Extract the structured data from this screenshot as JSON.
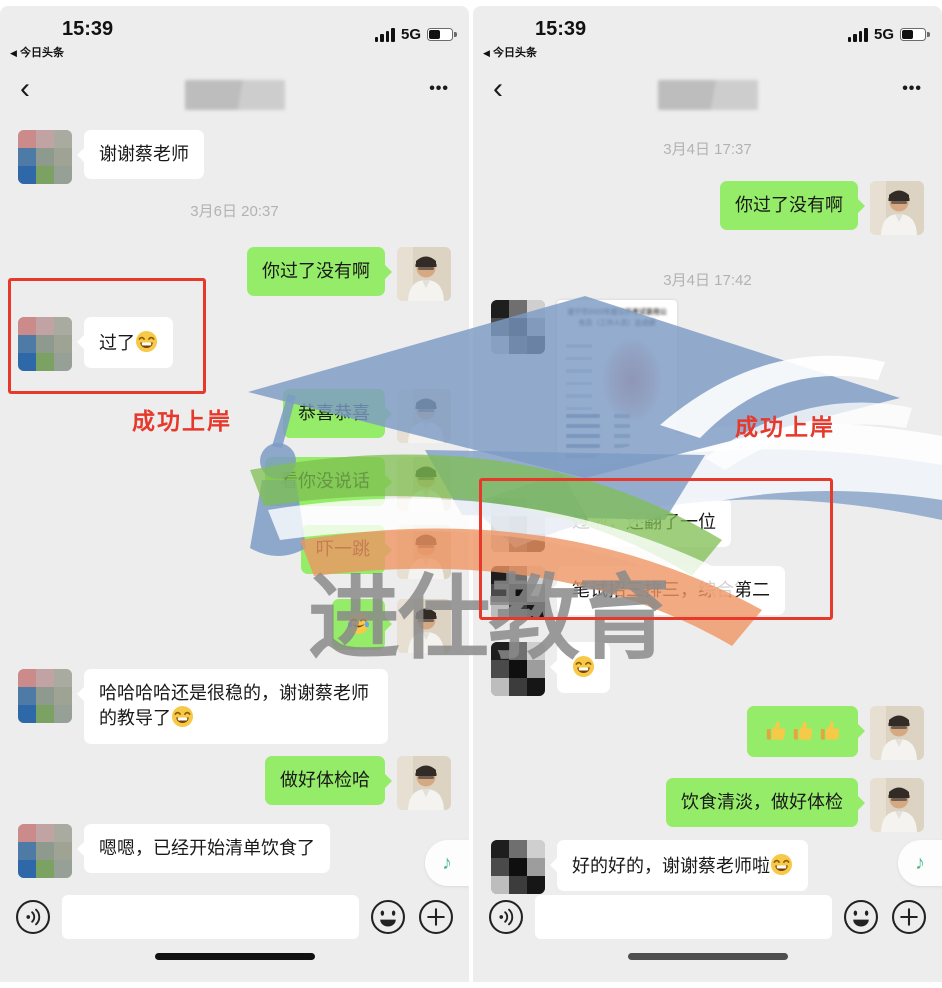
{
  "status_bar": {
    "time": "15:39",
    "back_app": "今日头条",
    "network": "5G"
  },
  "nav": {
    "back_glyph": "‹",
    "more_glyph": "•••"
  },
  "icons": {
    "back_to_app": "◀",
    "music_note": "♪",
    "voice": "voice-wave-in-circle",
    "emoji_picker": "smiley-face",
    "plus": "plus-in-circle"
  },
  "annotations": {
    "left_label": "成功上岸",
    "right_label": "成功上岸"
  },
  "watermark": {
    "brand": "进仕教育"
  },
  "colors": {
    "bubble_green": "#95ec69",
    "annotation_red": "#e6392c",
    "watermark_blue": "#7d9bc4"
  },
  "left_chat": {
    "t1": "3月6日 20:37",
    "m_thanks": "谢谢蔡老师",
    "m_pass_q": "你过了没有啊",
    "m_passed": "过了",
    "m_passed_emoji": "😁",
    "m_congrats": "恭喜恭喜",
    "m_silent": "看你没说话",
    "m_scared": "吓一跳",
    "m_joy_emoji": "😂",
    "m_stable": "哈哈哈哈还是很稳的，谢谢蔡老师的教导了",
    "m_stable_emoji": "😁",
    "m_checkup": "做好体检哈",
    "m_diet": "嗯嗯，已经开始清单饮食了"
  },
  "right_chat": {
    "t1": "3月4日 17:37",
    "m_pass_q": "你过了没有啊",
    "t2": "3月4日 17:42",
    "score_title": "遂宁市2023年度公开考试录用公务员（工作人员）总成绩",
    "m_passed": "过啦，还翻了一位",
    "m_rank": "笔试招三排三，综合第二",
    "m_grin_emoji": "😁",
    "m_thumbs_emoji": "👍👍👍",
    "m_advice": "饮食清淡，做好体检",
    "m_ok": "好的好的，谢谢蔡老师啦",
    "m_ok_emoji": "😁"
  }
}
